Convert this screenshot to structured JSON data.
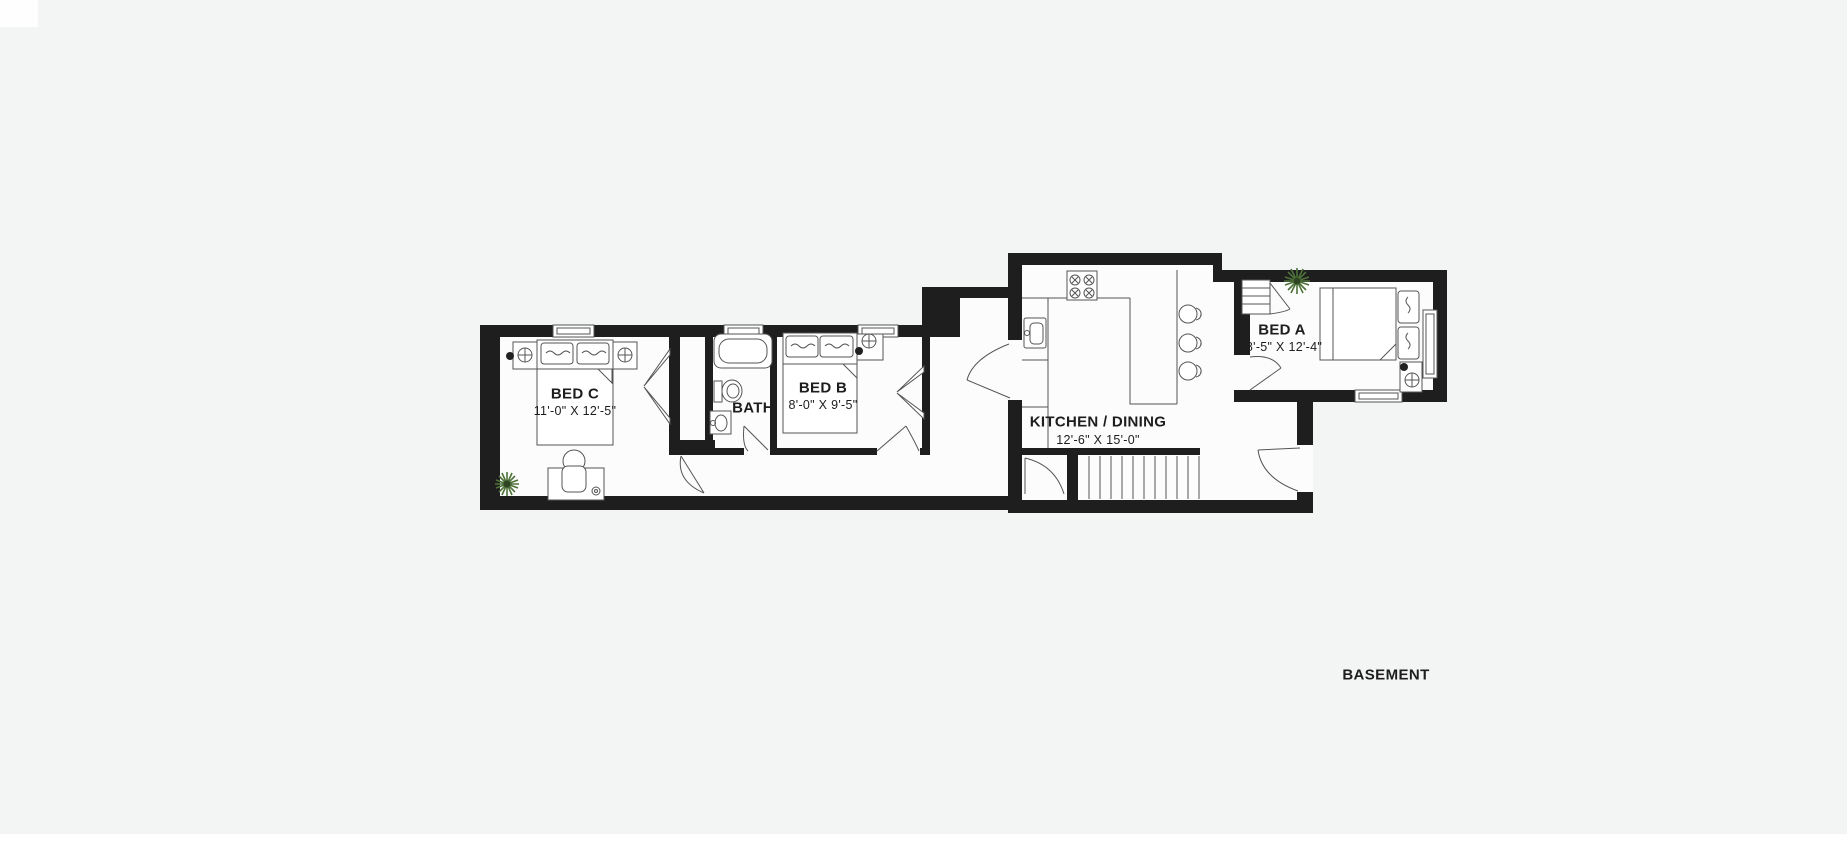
{
  "canvas": {
    "background": "#f3f4f4",
    "floor_color": "#fcfcfc",
    "wall_color": "#1e1e1e",
    "line_color": "#555555",
    "plant_color": "#4e7239"
  },
  "floor_label": "BASEMENT",
  "rooms": {
    "bed_c": {
      "name": "BED C",
      "dims": "11'-0\" X 12'-5\""
    },
    "bath": {
      "name": "BATH"
    },
    "bed_b": {
      "name": "BED B",
      "dims": "8'-0\" X 9'-5\""
    },
    "kitchen_dining": {
      "name": "KITCHEN / DINING",
      "dims": "12'-6\" X 15'-0\""
    },
    "bed_a": {
      "name": "BED A",
      "dims": "8'-5\" X 12'-4\""
    }
  }
}
